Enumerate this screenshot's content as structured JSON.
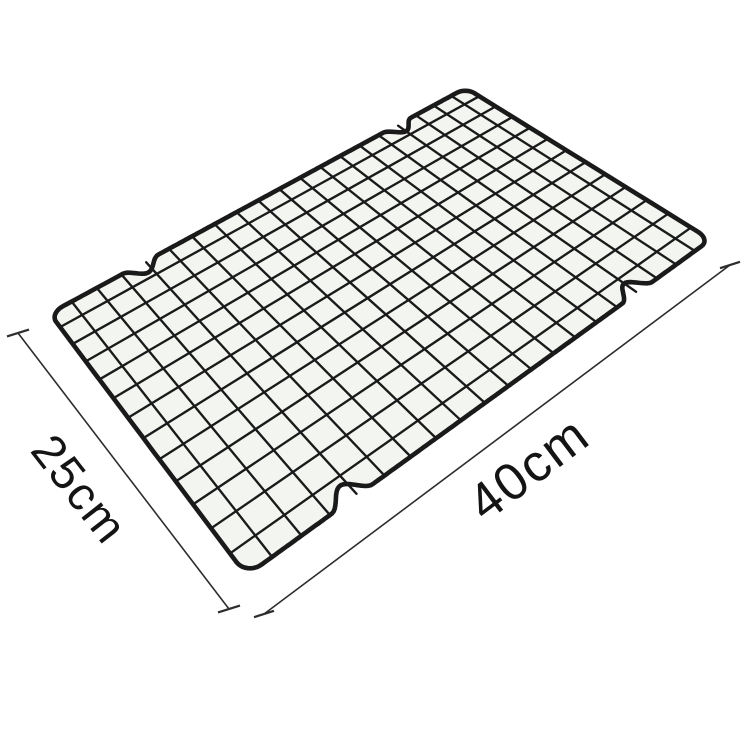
{
  "background_color": "#ffffff",
  "product_figure": {
    "kind": "wire-cooling-rack-photo",
    "wire_color": "#1a1a1a",
    "cell_tint": "#f3f5f1",
    "grid_columns": 20,
    "grid_rows": 13,
    "flat_width": 400,
    "flat_height": 250,
    "border_radius": 10,
    "border_stroke": 4.6,
    "grid_stroke": 2.35,
    "corners": {
      "left": [
        44,
        313
      ],
      "top": [
        466,
        85
      ],
      "right": [
        717,
        240
      ],
      "bottom": [
        245,
        583
      ]
    },
    "notch_fractions": [
      0.19,
      0.8
    ],
    "notch_half_width": 15,
    "notch_depth": 11
  },
  "dimensions": {
    "line_color": "#2d2d2d",
    "text_color": "#141414",
    "depth_label": "25cm",
    "width_label": "40cm",
    "depth_line": {
      "x1": 18,
      "y1": 333,
      "x2": 229,
      "y2": 609,
      "tick_angle": -17,
      "tick_len": 23
    },
    "width_line": {
      "x1": 264,
      "y1": 614,
      "x2": 730,
      "y2": 265,
      "tick_angle": -18,
      "tick_len": 21
    },
    "depth_label_pos": {
      "x": 80,
      "y": 489,
      "rotate": 52,
      "font_size": 47
    },
    "width_label_pos": {
      "x": 529,
      "y": 469,
      "rotate": -37,
      "font_size": 52
    }
  }
}
